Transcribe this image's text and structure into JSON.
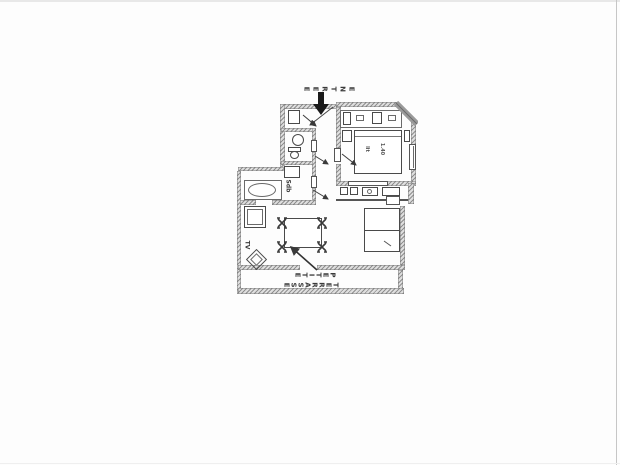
{
  "page": {
    "background": "#fdfdfd",
    "edge_top_color": "#e8e8e8",
    "edge_right_color": "#c6c6c6",
    "edge_bottom_color": "#efefef"
  },
  "plan": {
    "type": "scanned apartment floor plan",
    "ink_color": "#3a3a3a",
    "wall_color": "#8f8f8f",
    "entrance_arrow_color": "#1a1a1a",
    "labels": {
      "entrance": "ENTREE",
      "terrace_line1": "PETITE",
      "terrace_line2": "TERRASSE",
      "tv": "TV",
      "bathroom": "Sdb",
      "bed_word": "lit",
      "bed_size": "1.40"
    }
  }
}
